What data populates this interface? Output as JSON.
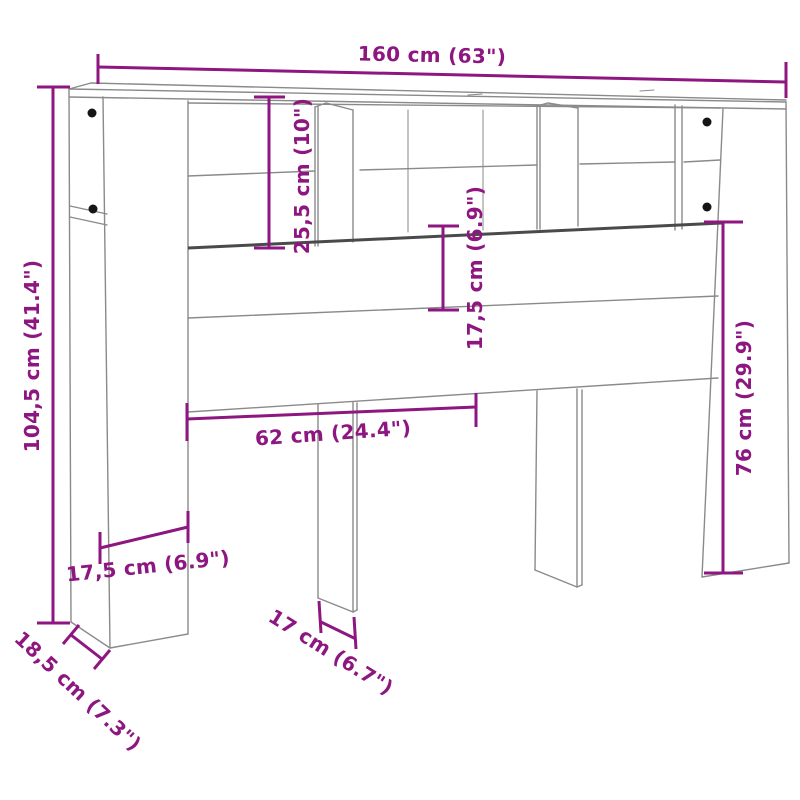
{
  "diagram": {
    "kind": "furniture-dimension-diagram",
    "subject": "headboard-cabinet-line-drawing",
    "colors": {
      "dimension_accent": "#8d1680",
      "outline_gray": "#8a8a8a",
      "shelf_edge_dark": "#4a4a4a",
      "background": "#ffffff"
    },
    "dimensions": {
      "overall_width": "160 cm (63\")",
      "overall_height": "104,5 cm (41.4\")",
      "shelf_section_height": "25,5 cm (10\")",
      "middle_rail_height": "17,5 cm (6.9\")",
      "lower_right_height": "76 cm (29.9\")",
      "opening_width": "62 cm (24.4\")",
      "side_panel_depth": "17,5 cm (6.9\")",
      "base_depth": "18,5 cm (7.3\")",
      "leg_width": "17 cm (6.7\")"
    }
  }
}
